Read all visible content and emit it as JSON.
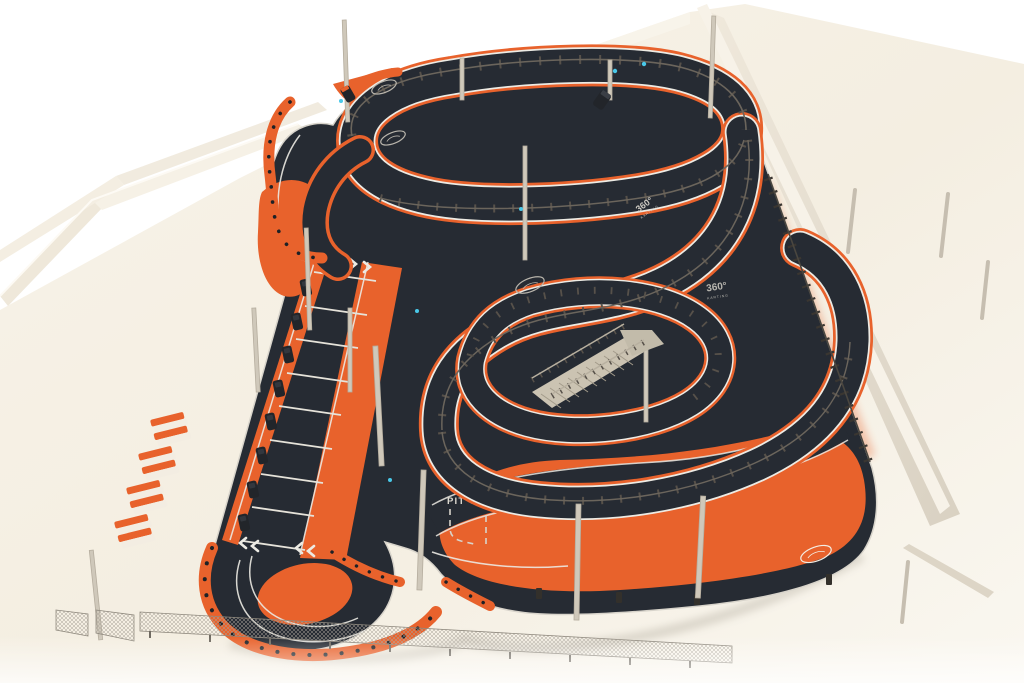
{
  "scene": {
    "description": "Isometric 3D render of a two-level indoor go-kart circuit in orange and dark asphalt inside a white industrial hall",
    "view": "isometric overview"
  },
  "track": {
    "markings": {
      "pit_out": "PIT OUT",
      "logo_primary": "360°",
      "logo_secondary": "KARTING"
    },
    "features": {
      "levels": 2,
      "pit_bays": 8,
      "pit_karts": 8,
      "chevron_arrows_forward": 4,
      "chevron_arrows_reverse": 4,
      "barrier_stack_groups": 4,
      "oval_brand_badges": 4
    },
    "colors": {
      "asphalt": "#262B33",
      "accent_orange": "#E8622C",
      "floor": "#F5EFE3",
      "wall": "#E9E2D4",
      "steel": "#C9C2B4",
      "white_line": "#ECEAE3",
      "marker_cyan": "#49C8E8"
    }
  }
}
